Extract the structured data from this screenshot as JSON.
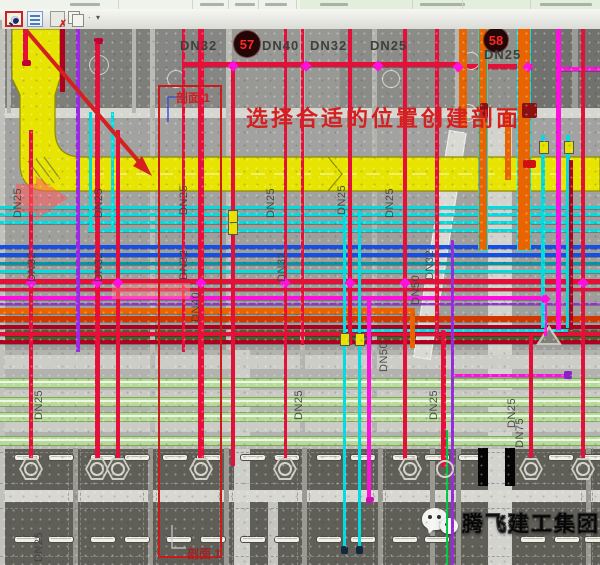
{
  "window": {
    "toolbar_icons": [
      "section-tool-icon",
      "properties-palette-icon",
      "purge-icon",
      "paste-icon",
      "dropdown-arrow"
    ],
    "ribbon_blobs": [
      [
        70,
        30
      ],
      [
        200,
        24
      ],
      [
        235,
        20
      ],
      [
        265,
        22
      ],
      [
        320,
        28
      ],
      [
        420,
        45
      ],
      [
        540,
        52
      ]
    ],
    "ribbon_dividers": [
      118,
      192,
      228,
      258,
      296,
      412,
      462,
      530
    ]
  },
  "colors": {
    "red": "#e4103a",
    "darkred": "#b00020",
    "cyan": "#00dce0",
    "blue": "#1450e8",
    "teal": "#0096ac",
    "magenta": "#ff10dc",
    "violet": "#9a2ae0",
    "orange": "#e86400",
    "orange2": "#d03800",
    "green_soft": "#b7d99c",
    "green_bright": "#00c846",
    "duct": "#e6e400",
    "duct_edge": "#8f8c00",
    "annotation": "#d42020",
    "box": "#cc1a1a",
    "tag_bg": "#250607",
    "tag_text": "#ff2828",
    "label": "#3f3f3c",
    "beam": "#d7d7d2",
    "slab": "#5f5f57",
    "watermark": "#fafafa",
    "blue_leader": "#3c55cc",
    "yellow_valve": "#e8e000",
    "olive": "#555a30"
  },
  "annotations": {
    "instruction": "选择合适的位置创建剖面",
    "section_label_top": "剖面 1",
    "section_label_bottom": "剖面 1",
    "section_box": {
      "x": 158,
      "y": 56,
      "w": 64,
      "h": 473
    },
    "instruction_pos": {
      "x": 246,
      "y": 72
    },
    "label_top_pos": {
      "x": 176,
      "y": 60
    },
    "label_bottom_pos": {
      "x": 187,
      "y": 516
    }
  },
  "tags": [
    {
      "text": "57",
      "cx": 247,
      "cy": 15,
      "r": 13
    },
    {
      "text": "58",
      "cx": 496,
      "cy": 11,
      "r": 12
    }
  ],
  "dn_top_labels": [
    {
      "text": "DN32",
      "x": 180,
      "y": 9
    },
    {
      "text": "DN40",
      "x": 262,
      "y": 9
    },
    {
      "text": "DN32",
      "x": 310,
      "y": 9
    },
    {
      "text": "DN25",
      "x": 370,
      "y": 9
    },
    {
      "text": "DN25",
      "x": 484,
      "y": 18
    }
  ],
  "rotated_labels": [
    {
      "text": "DN25",
      "x": 12,
      "y": 189
    },
    {
      "text": "DN25",
      "x": 93,
      "y": 189
    },
    {
      "text": "DN25",
      "x": 178,
      "y": 186
    },
    {
      "text": "DN25",
      "x": 265,
      "y": 189
    },
    {
      "text": "DN25",
      "x": 336,
      "y": 186
    },
    {
      "text": "DN25",
      "x": 384,
      "y": 189
    },
    {
      "text": "DN32",
      "x": 26,
      "y": 253
    },
    {
      "text": "DN32",
      "x": 93,
      "y": 253
    },
    {
      "text": "DN32",
      "x": 178,
      "y": 251
    },
    {
      "text": "DN32",
      "x": 276,
      "y": 253
    },
    {
      "text": "DN32",
      "x": 424,
      "y": 251
    },
    {
      "text": "DN40",
      "x": 190,
      "y": 293
    },
    {
      "text": "DN50",
      "x": 410,
      "y": 276
    },
    {
      "text": "DN50",
      "x": 378,
      "y": 343
    },
    {
      "text": "DN25",
      "x": 33,
      "y": 391
    },
    {
      "text": "DN25",
      "x": 293,
      "y": 391
    },
    {
      "text": "DN25",
      "x": 428,
      "y": 391
    },
    {
      "text": "DN25",
      "x": 506,
      "y": 399
    },
    {
      "text": "DN75",
      "x": 514,
      "y": 419
    },
    {
      "text": "DN25",
      "x": 33,
      "y": 533
    }
  ],
  "scene": {
    "panels": [
      {
        "x": 0,
        "y": 0,
        "w": 600,
        "h": 84,
        "c": "#868684"
      },
      {
        "x": 0,
        "y": 0,
        "w": 150,
        "h": 80,
        "c": "#7e7e7b"
      },
      {
        "x": 230,
        "y": 0,
        "w": 110,
        "h": 80,
        "c": "#989895"
      },
      {
        "x": 340,
        "y": 0,
        "w": 115,
        "h": 80,
        "c": "#8b8b88"
      },
      {
        "x": 455,
        "y": 0,
        "w": 75,
        "h": 84,
        "c": "#90908d"
      },
      {
        "x": 530,
        "y": 0,
        "w": 70,
        "h": 100,
        "c": "#71716d"
      },
      {
        "x": 572,
        "y": 0,
        "w": 6,
        "h": 100,
        "c": "#9a9a96"
      },
      {
        "x": 517,
        "y": 99,
        "w": 83,
        "h": 13,
        "c": "#5e5e5a"
      },
      {
        "x": 0,
        "y": 83,
        "w": 600,
        "h": 93,
        "c": "#a2a2a0"
      },
      {
        "x": 0,
        "y": 176,
        "w": 600,
        "h": 145,
        "c": "#9e9e9b"
      },
      {
        "x": 0,
        "y": 321,
        "w": 600,
        "h": 98,
        "c": "#b2b2ae"
      },
      {
        "x": 0,
        "y": 419,
        "w": 600,
        "h": 117,
        "c": "#5f5f57"
      },
      {
        "x": 234,
        "y": 321,
        "w": 16,
        "h": 215,
        "c": "#cfcfca"
      },
      {
        "x": 488,
        "y": 83,
        "w": 24,
        "h": 453,
        "c": "#d3d3ce"
      },
      {
        "x": 268,
        "y": 471,
        "w": 10,
        "h": 65,
        "c": "#c5c5c0"
      },
      {
        "x": 0,
        "y": 301,
        "w": 600,
        "h": 10,
        "c": "#555a30"
      }
    ],
    "beams_h": [
      {
        "x": 0,
        "y": 79,
        "w": 600,
        "h": 10,
        "c": "#d7d7d2"
      },
      {
        "x": 0,
        "y": 326,
        "w": 600,
        "h": 14,
        "c": "#cdcdc8"
      },
      {
        "x": 0,
        "y": 361,
        "w": 600,
        "h": 7,
        "c": "#c9c9c4"
      },
      {
        "x": 0,
        "y": 391,
        "w": 600,
        "h": 12,
        "c": "#ccccc7"
      },
      {
        "x": 0,
        "y": 417,
        "w": 600,
        "h": 3,
        "c": "#b9b9b4"
      },
      {
        "x": 0,
        "y": 461,
        "w": 600,
        "h": 12,
        "c": "#d8d8d3"
      }
    ],
    "beams_v": [
      {
        "x": 0,
        "y": 0,
        "w": 5,
        "h": 536,
        "c": "#c2c2bd"
      },
      {
        "x": 7,
        "y": 0,
        "w": 4,
        "h": 84,
        "c": "#b5b5b1"
      },
      {
        "x": 132,
        "y": 0,
        "w": 4,
        "h": 84,
        "c": "#b5b5b1"
      },
      {
        "x": 150,
        "y": 0,
        "w": 5,
        "h": 419,
        "c": "#bcbcb7"
      },
      {
        "x": 226,
        "y": 0,
        "w": 6,
        "h": 321,
        "c": "#bcbcb7"
      },
      {
        "x": 300,
        "y": 0,
        "w": 5,
        "h": 419,
        "c": "#b3b3af"
      },
      {
        "x": 372,
        "y": 0,
        "w": 5,
        "h": 419,
        "c": "#b3b3af"
      },
      {
        "x": 455,
        "y": 0,
        "w": 4,
        "h": 84,
        "c": "#b5b5b1"
      },
      {
        "x": 73,
        "y": 419,
        "w": 5,
        "h": 117,
        "c": "#9a9a92"
      },
      {
        "x": 148,
        "y": 419,
        "w": 5,
        "h": 117,
        "c": "#9a9a92"
      },
      {
        "x": 224,
        "y": 419,
        "w": 5,
        "h": 117,
        "c": "#9a9a92"
      },
      {
        "x": 302,
        "y": 419,
        "w": 5,
        "h": 117,
        "c": "#9a9a92"
      },
      {
        "x": 378,
        "y": 419,
        "w": 5,
        "h": 117,
        "c": "#9a9a92"
      },
      {
        "x": 430,
        "y": 419,
        "w": 5,
        "h": 117,
        "c": "#9a9a92"
      },
      {
        "x": 456,
        "y": 419,
        "w": 5,
        "h": 117,
        "c": "#9a9a92"
      },
      {
        "x": 586,
        "y": 419,
        "w": 5,
        "h": 117,
        "c": "#9a9a92"
      }
    ],
    "dashed_h": [
      423,
      454,
      479,
      527
    ],
    "dashed_v": [
      68,
      80,
      143,
      156,
      219,
      232,
      297,
      309,
      373,
      385,
      581,
      592
    ],
    "green_bands": [
      349,
      368,
      383,
      407
    ],
    "ramp": {
      "x": 449,
      "y": 101,
      "w": 16,
      "h": 228,
      "rot": 9
    },
    "h_pipes": [
      {
        "x1": 183,
        "x2": 458,
        "y": 33,
        "w": 5,
        "c": "red"
      },
      {
        "x1": 455,
        "x2": 532,
        "y": 35,
        "w": 5,
        "c": "red"
      },
      {
        "x1": 560,
        "x2": 600,
        "y": 38,
        "w": 4,
        "c": "magenta"
      },
      {
        "x1": 0,
        "x2": 600,
        "y": 177,
        "w": 3,
        "c": "cyan"
      },
      {
        "x1": 0,
        "x2": 600,
        "y": 184,
        "w": 3,
        "c": "cyan"
      },
      {
        "x1": 0,
        "x2": 600,
        "y": 192,
        "w": 3,
        "c": "cyan"
      },
      {
        "x1": 88,
        "x2": 600,
        "y": 200,
        "w": 3,
        "c": "cyan"
      },
      {
        "x1": 0,
        "x2": 600,
        "y": 216,
        "w": 4,
        "c": "blue"
      },
      {
        "x1": 0,
        "x2": 600,
        "y": 224,
        "w": 4,
        "c": "blue"
      },
      {
        "x1": 0,
        "x2": 600,
        "y": 233,
        "w": 3,
        "c": "teal"
      },
      {
        "x1": 0,
        "x2": 600,
        "y": 241,
        "w": 3,
        "c": "cyan"
      },
      {
        "x1": 0,
        "x2": 600,
        "y": 250,
        "w": 5,
        "c": "red"
      },
      {
        "x1": 0,
        "x2": 600,
        "y": 259,
        "w": 3,
        "c": "red"
      },
      {
        "x1": 0,
        "x2": 548,
        "y": 267,
        "w": 4,
        "c": "magenta"
      },
      {
        "x1": 0,
        "x2": 600,
        "y": 274,
        "w": 2,
        "c": "violet"
      },
      {
        "x1": 0,
        "x2": 413,
        "y": 279,
        "w": 6,
        "c": "orange"
      },
      {
        "x1": 0,
        "x2": 600,
        "y": 287,
        "w": 6,
        "c": "orange2"
      },
      {
        "x1": 0,
        "x2": 600,
        "y": 296,
        "w": 4,
        "c": "darkred"
      },
      {
        "x1": 0,
        "x2": 600,
        "y": 303,
        "w": 4,
        "c": "red"
      },
      {
        "x1": 0,
        "x2": 600,
        "y": 311,
        "w": 4,
        "c": "darkred"
      },
      {
        "x1": 343,
        "x2": 568,
        "y": 300,
        "w": 3,
        "c": "cyan"
      },
      {
        "x1": 452,
        "x2": 570,
        "y": 345,
        "w": 3,
        "c": "magenta"
      }
    ],
    "v_pipes": [
      {
        "x": 25,
        "y1": 0,
        "y2": 35,
        "w": 5,
        "c": "red"
      },
      {
        "x": 62,
        "y1": 0,
        "y2": 63,
        "w": 5,
        "c": "darkred"
      },
      {
        "x": 78,
        "y1": 0,
        "y2": 323,
        "w": 4,
        "c": "violet"
      },
      {
        "x": 90,
        "y1": 83,
        "y2": 203,
        "w": 3,
        "c": "cyan"
      },
      {
        "x": 112,
        "y1": 83,
        "y2": 203,
        "w": 3,
        "c": "cyan"
      },
      {
        "x": 97,
        "y1": 11,
        "y2": 438,
        "w": 5,
        "c": "red"
      },
      {
        "x": 31,
        "y1": 101,
        "y2": 438,
        "w": 4,
        "c": "red"
      },
      {
        "x": 118,
        "y1": 101,
        "y2": 438,
        "w": 4,
        "c": "red"
      },
      {
        "x": 183,
        "y1": 0,
        "y2": 323,
        "w": 3,
        "c": "red"
      },
      {
        "x": 201,
        "y1": 0,
        "y2": 437,
        "w": 6,
        "c": "red"
      },
      {
        "x": 233,
        "y1": 35,
        "y2": 437,
        "w": 4,
        "c": "red"
      },
      {
        "x": 285,
        "y1": 0,
        "y2": 437,
        "w": 3,
        "c": "red"
      },
      {
        "x": 302,
        "y1": 0,
        "y2": 316,
        "w": 3,
        "c": "red"
      },
      {
        "x": 350,
        "y1": 0,
        "y2": 316,
        "w": 4,
        "c": "red"
      },
      {
        "x": 344,
        "y1": 181,
        "y2": 523,
        "w": 3,
        "c": "cyan"
      },
      {
        "x": 359,
        "y1": 181,
        "y2": 523,
        "w": 3,
        "c": "cyan"
      },
      {
        "x": 369,
        "y1": 271,
        "y2": 471,
        "w": 4,
        "c": "magenta"
      },
      {
        "x": 405,
        "y1": 0,
        "y2": 437,
        "w": 4,
        "c": "red"
      },
      {
        "x": 412,
        "y1": 279,
        "y2": 319,
        "w": 5,
        "c": "orange"
      },
      {
        "x": 437,
        "y1": 0,
        "y2": 311,
        "w": 4,
        "c": "red"
      },
      {
        "x": 443,
        "y1": 301,
        "y2": 438,
        "w": 5,
        "c": "red"
      },
      {
        "x": 447,
        "y1": 401,
        "y2": 536,
        "w": 2,
        "c": "green_bright"
      },
      {
        "x": 452,
        "y1": 211,
        "y2": 536,
        "w": 3,
        "c": "violet"
      },
      {
        "x": 463,
        "y1": 0,
        "y2": 99,
        "w": 8,
        "c": "orange"
      },
      {
        "x": 483,
        "y1": 0,
        "y2": 221,
        "w": 8,
        "c": "orange",
        "sel": true
      },
      {
        "x": 508,
        "y1": 83,
        "y2": 151,
        "w": 6,
        "c": "orange"
      },
      {
        "x": 524,
        "y1": 0,
        "y2": 221,
        "w": 12,
        "c": "orange",
        "sel": true
      },
      {
        "x": 531,
        "y1": 306,
        "y2": 439,
        "w": 4,
        "c": "red"
      },
      {
        "x": 545,
        "y1": 267,
        "y2": 307,
        "w": 3,
        "c": "magenta"
      },
      {
        "x": 543,
        "y1": 106,
        "y2": 299,
        "w": 4,
        "c": "cyan"
      },
      {
        "x": 568,
        "y1": 106,
        "y2": 299,
        "w": 4,
        "c": "cyan"
      },
      {
        "x": 558,
        "y1": 0,
        "y2": 301,
        "w": 5,
        "c": "magenta"
      },
      {
        "x": 571,
        "y1": 131,
        "y2": 301,
        "w": 4,
        "c": "darkred"
      },
      {
        "x": 583,
        "y1": 0,
        "y2": 437,
        "w": 4,
        "c": "red"
      }
    ],
    "caps": [
      {
        "x": 94,
        "y": 9,
        "w": 9,
        "h": 6,
        "c": "#c00030"
      },
      {
        "x": 22,
        "y": 31,
        "w": 9,
        "h": 6,
        "c": "#c00030"
      },
      {
        "x": 480,
        "y": 74,
        "w": 8,
        "h": 15,
        "c": "#8c1010"
      },
      {
        "x": 522,
        "y": 74,
        "w": 15,
        "h": 15,
        "c": "#8c1010"
      },
      {
        "x": 523,
        "y": 131,
        "w": 13,
        "h": 8,
        "c": "#d01010"
      },
      {
        "x": 366,
        "y": 468,
        "w": 8,
        "h": 6,
        "c": "#cc10b0"
      },
      {
        "x": 564,
        "y": 342,
        "w": 8,
        "h": 8,
        "c": "#8a20c8"
      },
      {
        "x": 341,
        "y": 517,
        "w": 7,
        "h": 8,
        "c": "#102840"
      },
      {
        "x": 356,
        "y": 517,
        "w": 7,
        "h": 8,
        "c": "#102840"
      }
    ],
    "nodes": [
      {
        "x": 233,
        "y": 35
      },
      {
        "x": 306,
        "y": 35
      },
      {
        "x": 378,
        "y": 35
      },
      {
        "x": 458,
        "y": 36
      },
      {
        "x": 528,
        "y": 36
      },
      {
        "x": 31,
        "y": 252
      },
      {
        "x": 97,
        "y": 252
      },
      {
        "x": 118,
        "y": 252
      },
      {
        "x": 201,
        "y": 252
      },
      {
        "x": 285,
        "y": 252
      },
      {
        "x": 350,
        "y": 252
      },
      {
        "x": 405,
        "y": 252
      },
      {
        "x": 583,
        "y": 252
      },
      {
        "x": 545,
        "y": 268
      }
    ],
    "hexagons": [
      31,
      97,
      118,
      201,
      285,
      410,
      531,
      583
    ],
    "hex_y": 429,
    "round_cap_fitting": {
      "x": 443,
      "y": 431
    },
    "valves": [
      {
        "x": 543,
        "y": 112
      },
      {
        "x": 568,
        "y": 112
      },
      {
        "x": 344,
        "y": 304
      },
      {
        "x": 359,
        "y": 304
      },
      {
        "x": 232,
        "y": 181
      },
      {
        "x": 232,
        "y": 193
      }
    ],
    "circles": [
      {
        "x": 98,
        "y": 35,
        "r": 9
      },
      {
        "x": 470,
        "y": 31,
        "r": 8
      },
      {
        "x": 467,
        "y": 83,
        "r": 8
      },
      {
        "x": 175,
        "y": 49,
        "r": 8
      },
      {
        "x": 390,
        "y": 49,
        "r": 8
      }
    ],
    "capsules_row1": {
      "y": 425,
      "xs": [
        14,
        48,
        90,
        124,
        162,
        196,
        240,
        274,
        316,
        350,
        392,
        424,
        458,
        548,
        582
      ]
    },
    "capsules_row2": {
      "y": 507,
      "xs": [
        14,
        48,
        90,
        124,
        166,
        200,
        240,
        274,
        316,
        350,
        392,
        424,
        520,
        554,
        584
      ]
    },
    "black_rects": [
      {
        "x": 478,
        "y": 419,
        "w": 10,
        "h": 38
      },
      {
        "x": 505,
        "y": 419,
        "w": 10,
        "h": 38
      }
    ],
    "triangles": [
      {
        "x": 536,
        "y": 296
      }
    ],
    "pink_arrow": {
      "x": 16,
      "y": 147,
      "w": 52,
      "h": 44
    },
    "pink_highlight": {
      "x": 112,
      "y": 254,
      "w": 78,
      "h": 16
    }
  },
  "watermark": {
    "text": "腾飞建工集团",
    "icon": "wechat-icon"
  }
}
